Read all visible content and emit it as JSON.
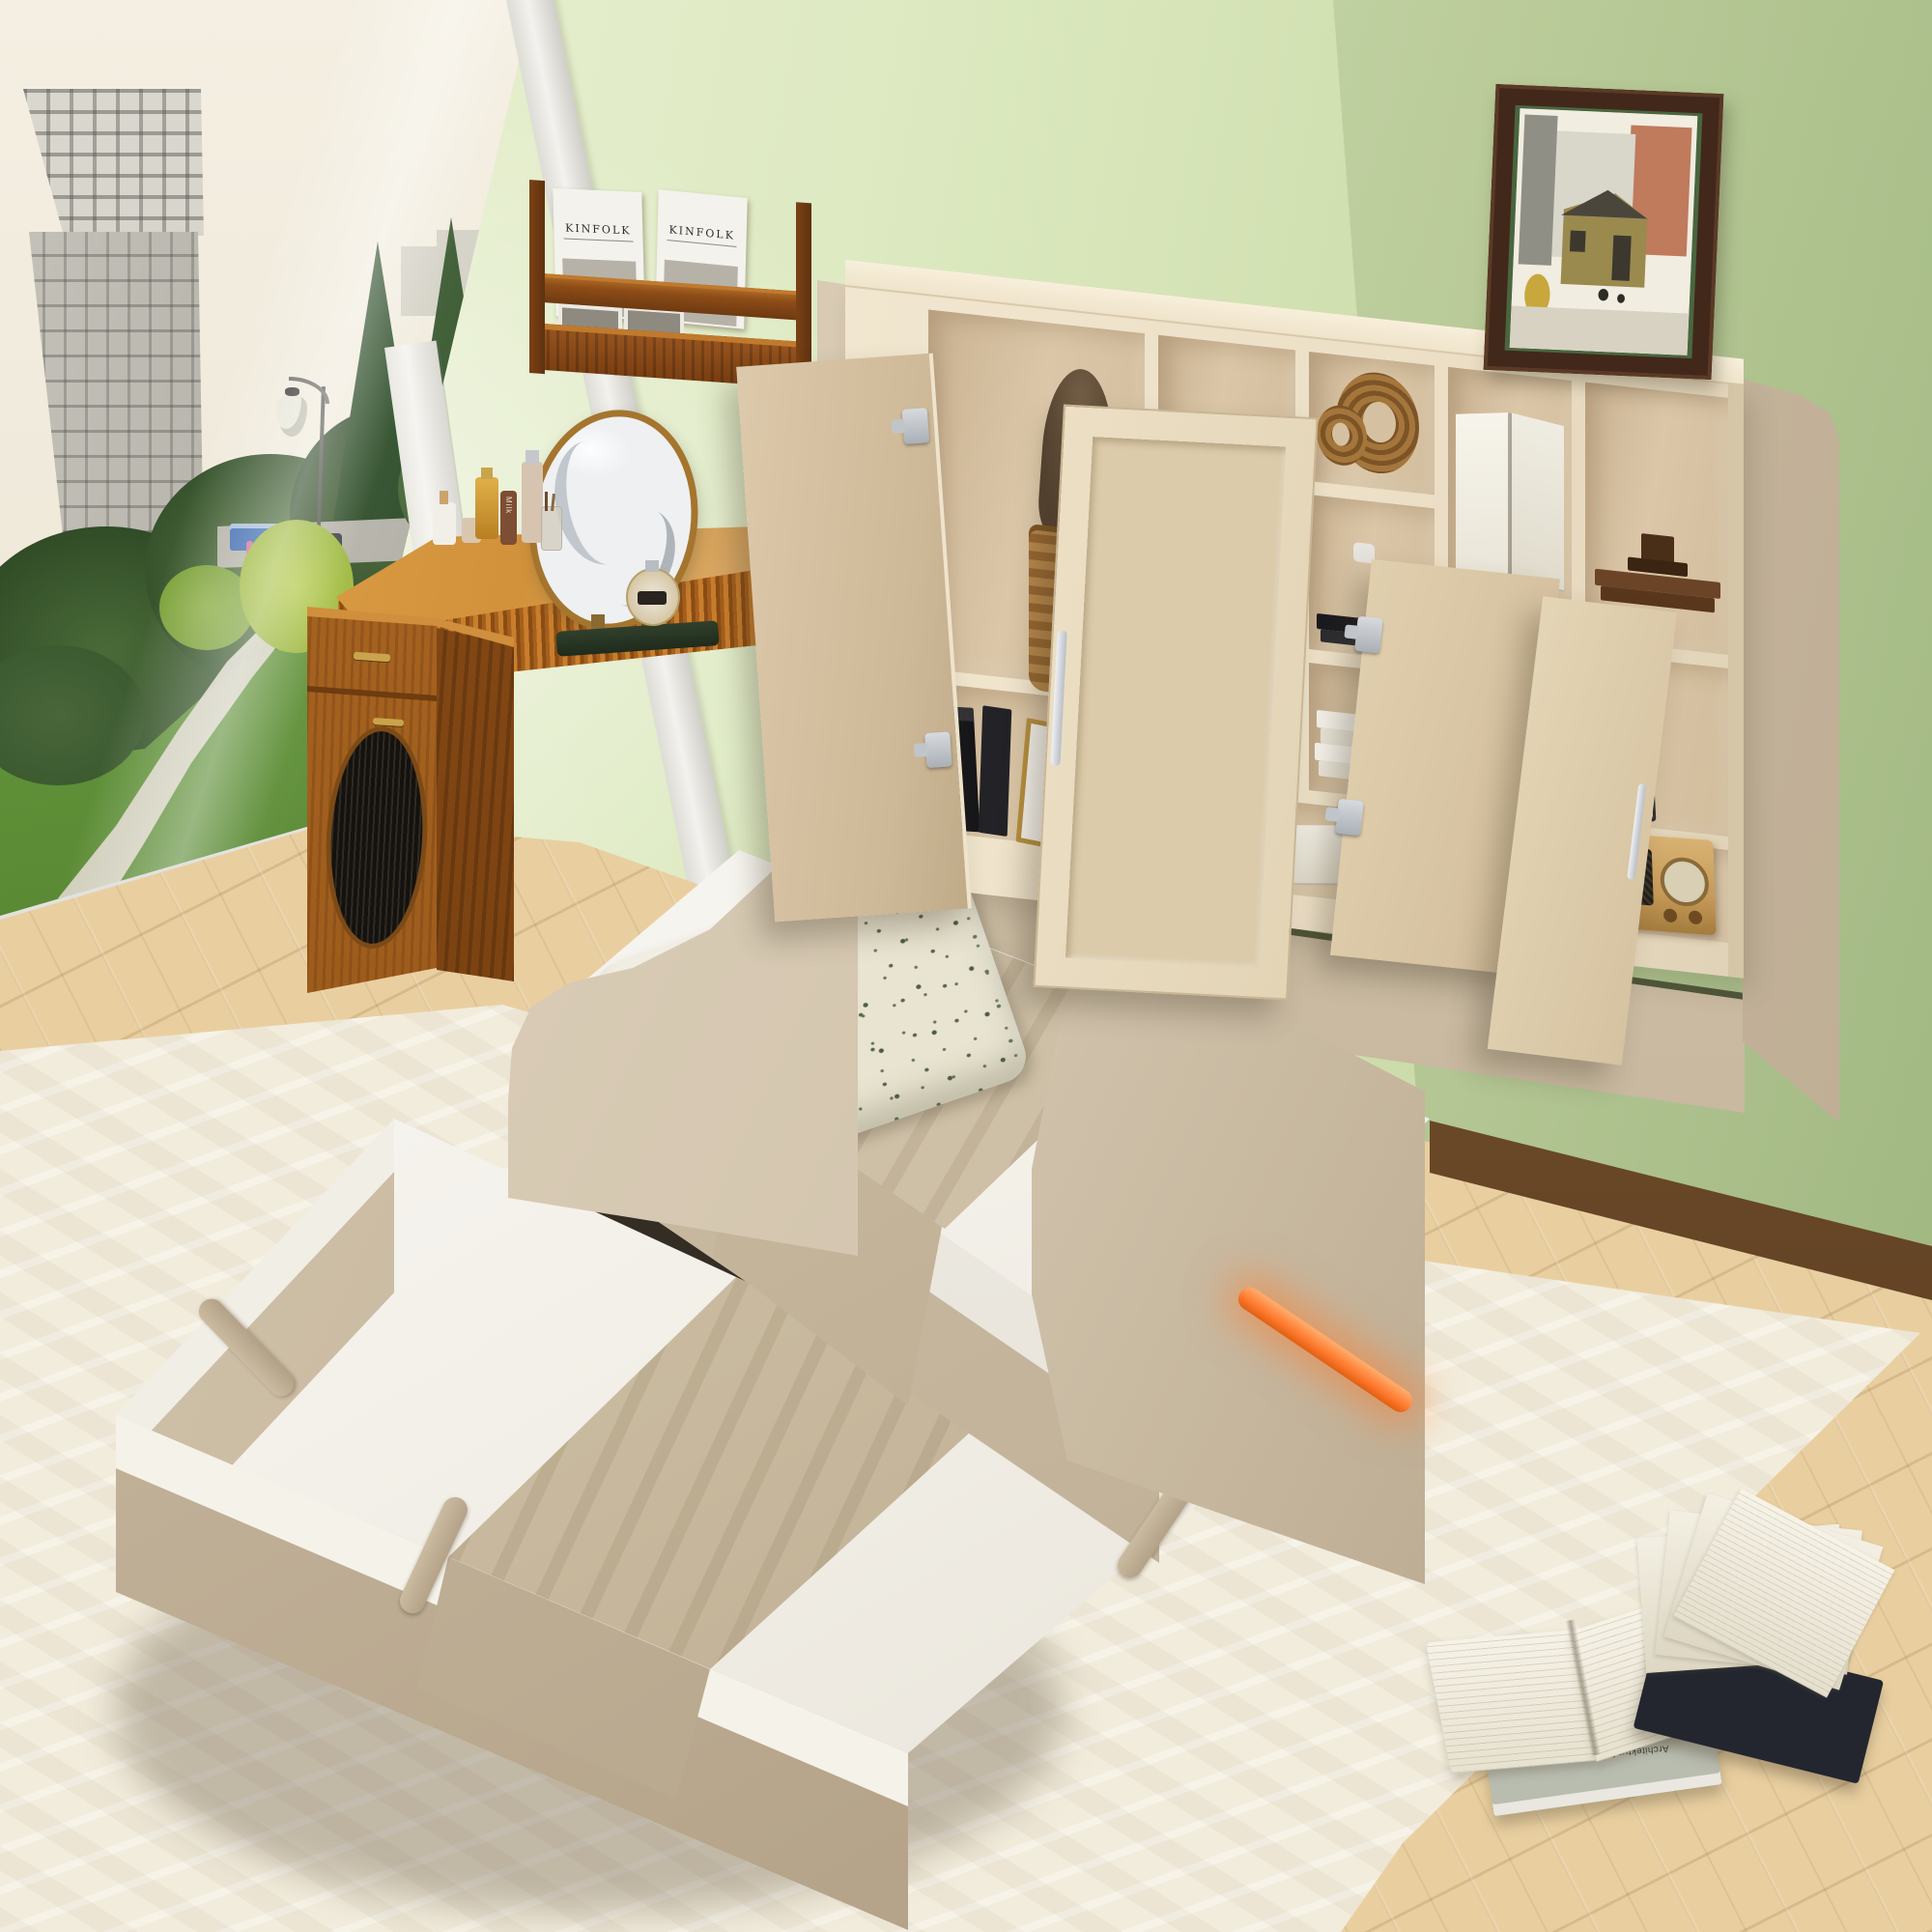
{
  "texts": {
    "kinfolk": "KINFOLK",
    "voyage": "Voyage",
    "savoring": "Savoring",
    "moser_author": "CARL MOSER",
    "moser_title": "Architektur für eine neue Zeit",
    "milk": "Milk"
  },
  "colors": {
    "wall1": "#eff3da",
    "wall2": "#dce9c0",
    "wall3": "#b6cd96",
    "tower": "#aeaba3",
    "grass": "#86b054",
    "road": "#b4b2a8",
    "path": "#d7d3c4",
    "truckBlue": "#3f6cb0",
    "lamp": "#e9e7da",
    "frameWhite": "#f3f2ee",
    "floor": "#e9cfa0",
    "baseboard": "#6b4a28",
    "rug": "#f2ecdc",
    "cream": "#ecdfc6",
    "interior": "#dbc7a8",
    "doorFace": "#e3d4b6",
    "doorInner": "#cdb897",
    "fabric": "#d3c5ae",
    "mattress": "#f4f1ea",
    "blanket": "#cdbfa6",
    "pillowBase": "#e9e4d1",
    "pillowMotif": "#57664a",
    "led": "#ff7a2e",
    "brass": "#c9a44c",
    "frameBrown": "#42281a",
    "frameMat": "#49663f",
    "artBlack": "#141414",
    "radioWood": "#c69a58",
    "heartWood": "#5d3d22"
  },
  "scene": {
    "description": "Beige upholstered twin daybed with bookcase storage headboard, open cabinet doors, pull-out trundle bed and orange LED strip, in a green-walled bedroom with floor-to-ceiling window, wooden vanity desk, wall magazine shelf and cream rug",
    "objects": [
      "window-park-view",
      "high-rise-building",
      "street-lamp",
      "magazine-wall-shelf",
      "vanity-desk",
      "round-mirror",
      "cosmetics",
      "pet-house-cabinet",
      "bookcase-headboard",
      "open-cabinet-doors",
      "woven-basket",
      "wood-ring-sculpture",
      "white-vase",
      "open-books",
      "heart-trophy",
      "leaf-art-print",
      "wire-basket",
      "vintage-radio",
      "framed-street-painting",
      "floral-pillow",
      "daybed-mattress",
      "trundle-bed",
      "led-light-strip",
      "area-rug",
      "books-on-floor"
    ]
  }
}
